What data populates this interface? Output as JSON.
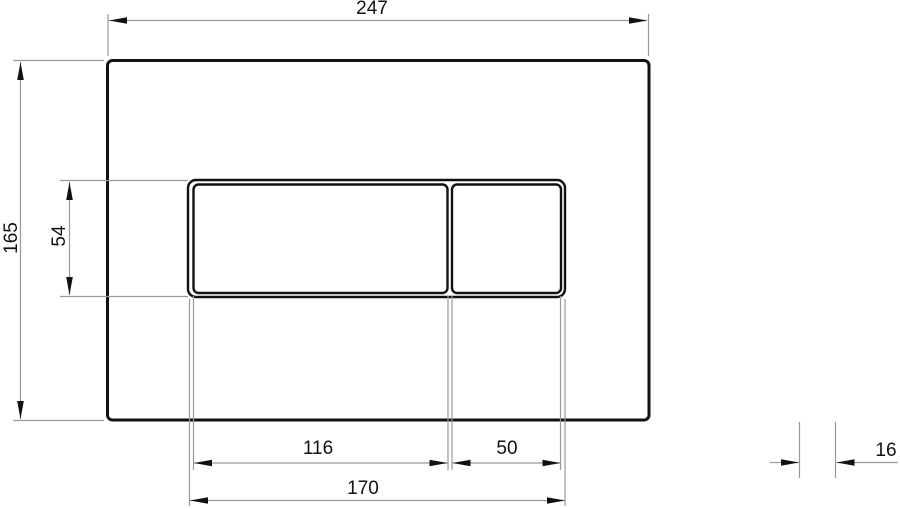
{
  "drawing": {
    "title": "Flush plate technical drawing",
    "views": {
      "front": {
        "dims": {
          "overall_width": "247",
          "overall_height": "165",
          "button_height": "54",
          "large_button_width": "116",
          "small_button_width": "50",
          "buttons_total_width": "170"
        }
      },
      "side": {
        "dims": {
          "thickness": "16"
        }
      }
    },
    "colors": {
      "background": "#ffffff",
      "outline": "#111111",
      "dim_line": "#999999",
      "dim_text": "#111111"
    }
  }
}
